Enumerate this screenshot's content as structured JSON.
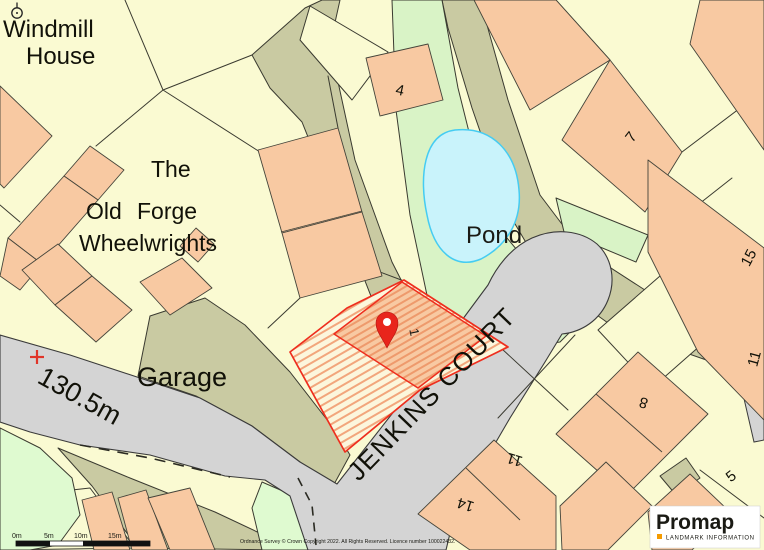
{
  "map": {
    "labels": {
      "windmill_line1": "Windmill",
      "windmill_line2": "House",
      "the": "The",
      "old": "Old",
      "forge": "Forge",
      "wheelwrights": "Wheelwrights",
      "garage": "Garage",
      "spot_height": "130.5m",
      "pond": "Pond",
      "street": "JENKINS COURT"
    },
    "house_numbers": {
      "n1": "1",
      "n4": "4",
      "n7": "7",
      "n15": "15",
      "n8": "8",
      "n11a": "11",
      "n14": "14",
      "n5": "5",
      "n11b": "11"
    },
    "scale_bar": {
      "t0": "0m",
      "t5": "5m",
      "t10": "10m",
      "t15": "15m"
    },
    "footer": {
      "copyright": "Ordnance Survey © Crown Copyright 2022. All Rights Reserved. Licence number 100022432."
    },
    "logo": {
      "name": "Promap",
      "tagline": "LANDMARK INFORMATION"
    },
    "colors": {
      "background": "#FAFAD2",
      "building": "#F8C9A2",
      "garden_olive": "#C9CAA2",
      "green": "#D9F3C6",
      "field_green": "#DFFAD0",
      "road": "#D4D4D4",
      "pond_fill": "#C9F3FB",
      "pond_edge": "#45CCF2",
      "pond_text": "#29A0E8",
      "plot_red": "#EE2E1E",
      "brand_orange": "#F59B00"
    }
  }
}
